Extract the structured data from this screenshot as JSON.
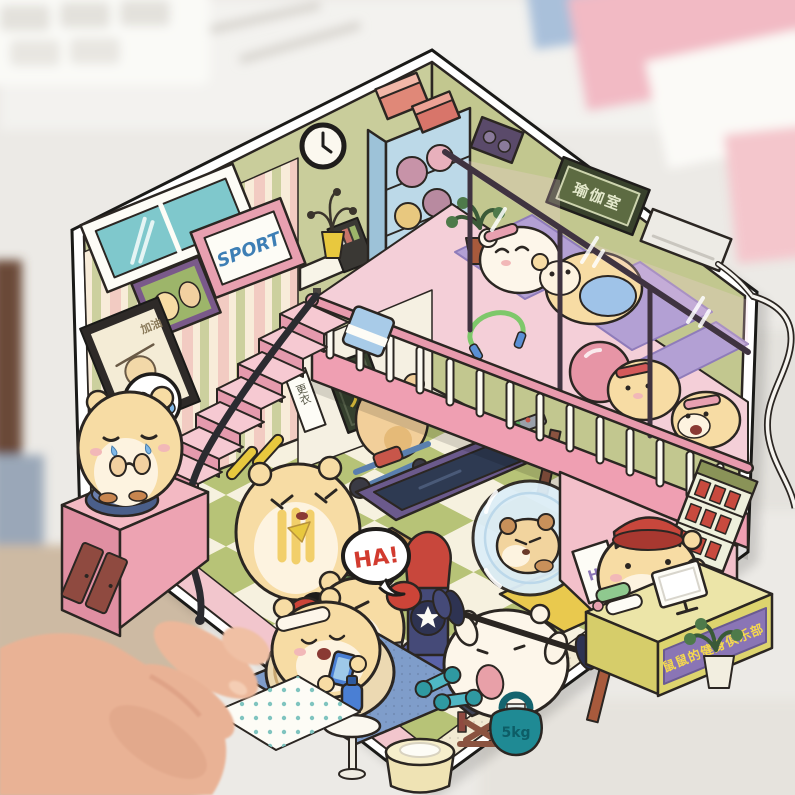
{
  "scene": {
    "type": "photo of illustrated die-cut sticker",
    "subject": "hexagonal sticker of an isometric cartoon hamster gym, held by a hand over a blurry desk",
    "card_shape": "hexagonal die-cut with white margin"
  },
  "palette": {
    "wall_olive": "#c9cd9b",
    "wall_olive_right": "#c2c78f",
    "stripe_cream": "#f8ecd9",
    "stripe_pink": "#f2cbc2",
    "stripe_olive": "#ccd09e",
    "floor_olive": "#b7c377",
    "floor_cream": "#f6f1df",
    "walkway_pink": "#f2c6cd",
    "mezzanine_pink": "#f4cfd8",
    "mat_purple": "#b3a0d4",
    "railing_pink": "#e89aad",
    "fascia_pink": "#ef9fb2",
    "stair_pink": "#f6c9d2",
    "stair_riser": "#e59aad",
    "reception_pink": "#f3c0ca",
    "desk_yellow": "#ddd46e",
    "desk_top": "#ece5a8",
    "banner_purple": "#8a75b5",
    "banner_text": "#f5d94e",
    "hamster_cream": "#f7dca4",
    "hamster_white": "#fdf6ea",
    "teal_equipment": "#1f8a94",
    "punch_red": "#c8473c",
    "punch_blue": "#5a62a8",
    "sign_green": "#5d6b42",
    "window_teal": "#7fc8cc",
    "ball_pink": "#e795a6",
    "rug_blue": "#7f9dca",
    "hand_skin": "#e9b295",
    "outline": "#2b2622"
  },
  "texts": {
    "sport_poster": "SPORT",
    "yoga_room_sign": "瑜伽室",
    "ha_bubble": "HA!",
    "exclaim_bubble": "!",
    "kettlebell_label": "5kg",
    "club_banner": "鼠鼠的健身俱乐部",
    "reception_sign_partial": "HE",
    "frame_caption": "加油",
    "changing_sign": "更衣",
    "strength_sign": "力"
  }
}
